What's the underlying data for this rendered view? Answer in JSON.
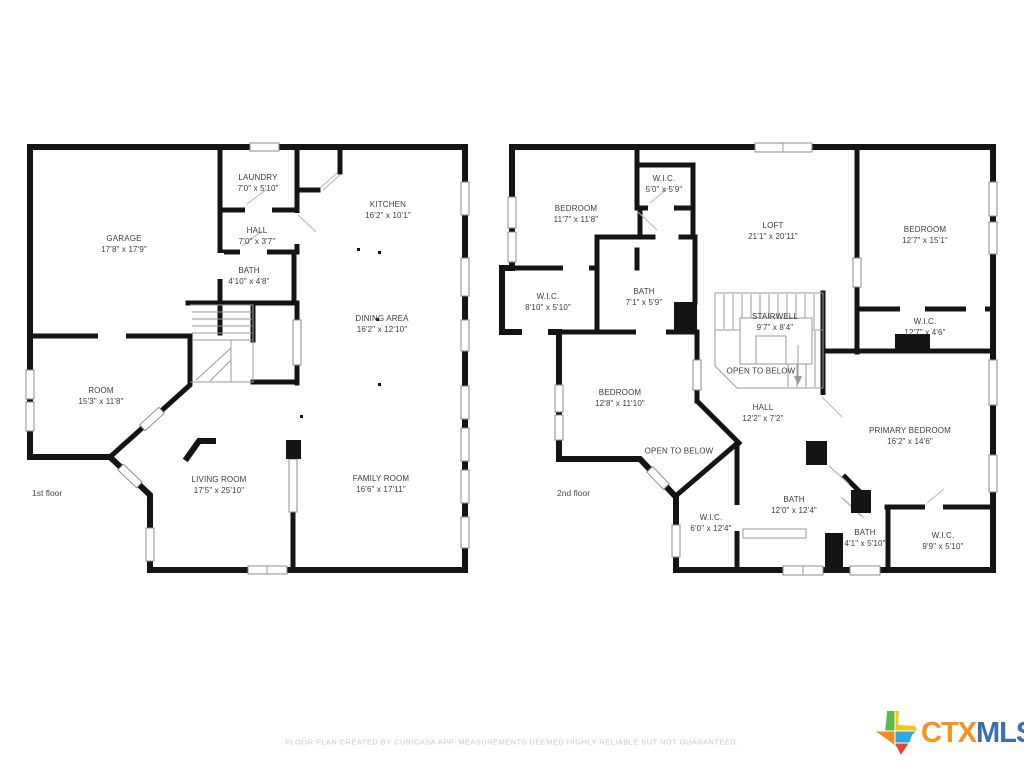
{
  "canvas": {
    "width": 1024,
    "height": 768,
    "background": "#ffffff",
    "wall_color": "#141414"
  },
  "floors": [
    {
      "label": "1st floor",
      "label_pos": {
        "x": 32,
        "y": 488
      },
      "rooms": [
        {
          "name": "GARAGE",
          "dims": "17'8\" x 17'9\"",
          "x": 124,
          "y": 244
        },
        {
          "name": "LAUNDRY",
          "dims": "7'0\" x 5'10\"",
          "x": 258,
          "y": 183
        },
        {
          "name": "HALL",
          "dims": "7'0\" x 3'7\"",
          "x": 257,
          "y": 236
        },
        {
          "name": "BATH",
          "dims": "4'10\" x 4'8\"",
          "x": 249,
          "y": 276
        },
        {
          "name": "KITCHEN",
          "dims": "16'2\" x 10'1\"",
          "x": 388,
          "y": 210
        },
        {
          "name": "DINING AREA",
          "dims": "16'2\" x 12'10\"",
          "x": 382,
          "y": 324
        },
        {
          "name": "ROOM",
          "dims": "15'3\" x 11'8\"",
          "x": 101,
          "y": 396
        },
        {
          "name": "LIVING ROOM",
          "dims": "17'5\" x 25'10\"",
          "x": 219,
          "y": 485
        },
        {
          "name": "FAMILY ROOM",
          "dims": "16'6\" x 17'11\"",
          "x": 381,
          "y": 484
        }
      ]
    },
    {
      "label": "2nd floor",
      "label_pos": {
        "x": 557,
        "y": 488
      },
      "rooms": [
        {
          "name": "BEDROOM",
          "dims": "11'7\" x 11'8\"",
          "x": 576,
          "y": 214
        },
        {
          "name": "W.I.C.",
          "dims": "5'0\" x 5'9\"",
          "x": 664,
          "y": 184
        },
        {
          "name": "LOFT",
          "dims": "21'1\" x 20'11\"",
          "x": 773,
          "y": 231
        },
        {
          "name": "BEDROOM",
          "dims": "12'7\" x 15'1\"",
          "x": 925,
          "y": 235
        },
        {
          "name": "W.I.C.",
          "dims": "8'10\" x 5'10\"",
          "x": 548,
          "y": 302
        },
        {
          "name": "BATH",
          "dims": "7'1\" x 5'9\"",
          "x": 644,
          "y": 297
        },
        {
          "name": "STAIRWELL",
          "dims": "9'7\" x 8'4\"",
          "x": 775,
          "y": 322
        },
        {
          "name": "W.I.C.",
          "dims": "12'7\" x 4'6\"",
          "x": 925,
          "y": 327
        },
        {
          "name": "OPEN TO BELOW",
          "dims": "",
          "x": 761,
          "y": 371
        },
        {
          "name": "BEDROOM",
          "dims": "12'8\" x 11'10\"",
          "x": 620,
          "y": 398
        },
        {
          "name": "HALL",
          "dims": "12'2\" x 7'2\"",
          "x": 763,
          "y": 413
        },
        {
          "name": "PRIMARY BEDROOM",
          "dims": "16'2\" x 14'6\"",
          "x": 910,
          "y": 436
        },
        {
          "name": "OPEN TO BELOW",
          "dims": "",
          "x": 679,
          "y": 451
        },
        {
          "name": "W.I.C.",
          "dims": "6'0\" x 12'4\"",
          "x": 711,
          "y": 523
        },
        {
          "name": "BATH",
          "dims": "12'0\" x 12'4\"",
          "x": 794,
          "y": 505
        },
        {
          "name": "BATH",
          "dims": "4'1\" x 5'10\"",
          "x": 865,
          "y": 538
        },
        {
          "name": "W.I.C.",
          "dims": "9'9\" x 5'10\"",
          "x": 943,
          "y": 541
        }
      ]
    }
  ],
  "footer": {
    "disclaimer": "FLOOR PLAN CREATED BY CUBICASA APP. MEASUREMENTS DEEMED HIGHLY RELIABLE BUT NOT GUARANTEED."
  },
  "logo": {
    "ctx": "CTX",
    "mls": "MLS",
    "colors": {
      "ctx": "#F6921E",
      "mls": "#3C6FB0",
      "texas_green": "#5CB947",
      "texas_yellow": "#FFC20E",
      "texas_orange": "#F68B1F",
      "texas_blue": "#29ABE2",
      "texas_red": "#E8432E"
    }
  }
}
